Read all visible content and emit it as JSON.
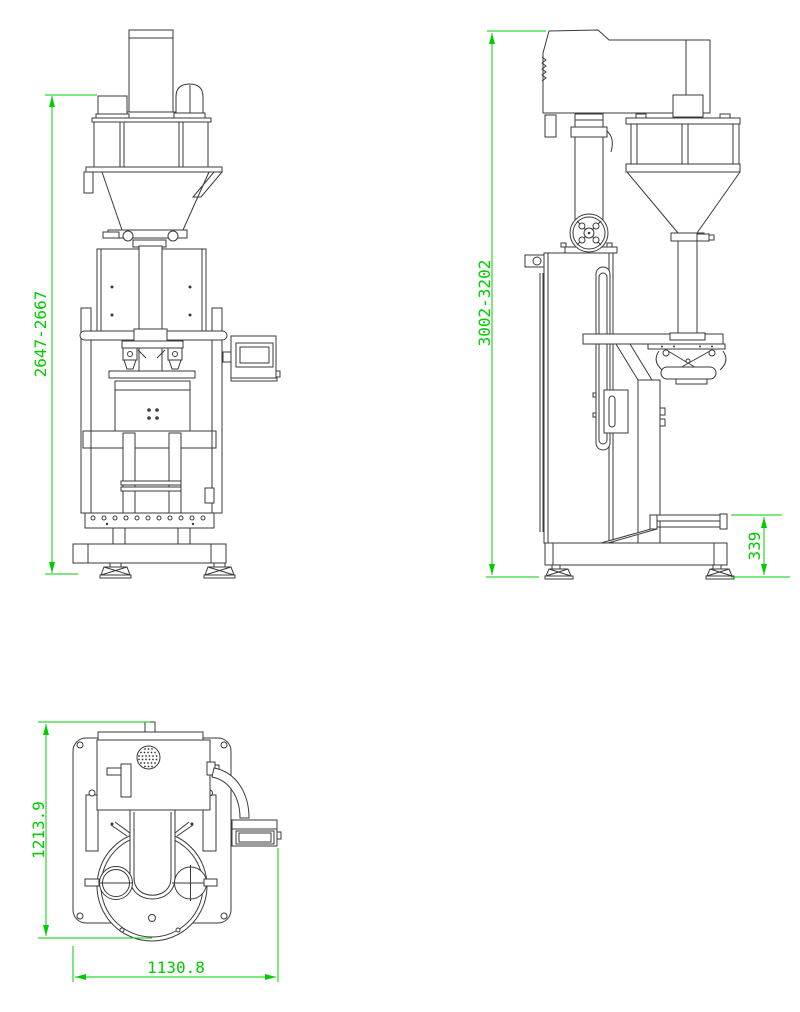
{
  "drawing": {
    "background_color": "#ffffff",
    "line_color": "#3a3a3a",
    "dimension_color": "#00cc00",
    "views": [
      "front-elevation",
      "side-elevation",
      "top-plan"
    ]
  },
  "dimensions": {
    "front_overall_height": "2647-2667",
    "side_overall_height": "3002-3202",
    "conveyor_height": "339",
    "top_view_depth": "1213.9",
    "top_view_width": "1130.8"
  }
}
